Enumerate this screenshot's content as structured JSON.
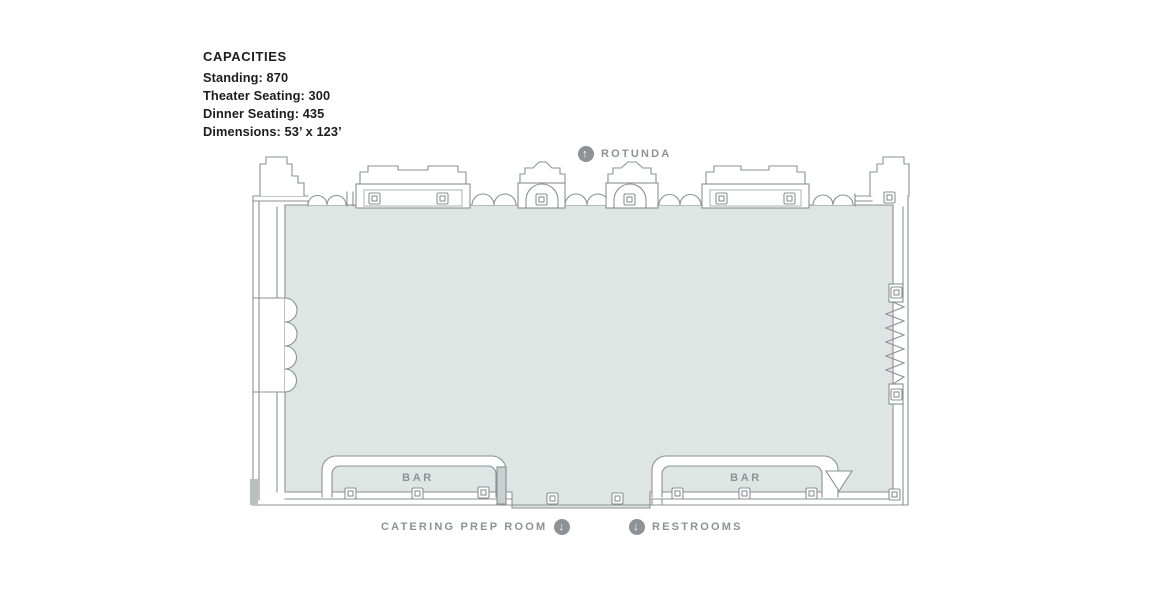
{
  "capacities": {
    "title": "CAPACITIES",
    "lines": [
      "Standing: 870",
      "Theater Seating: 300",
      "Dinner Seating: 435",
      "Dimensions: 53’ x 123’"
    ]
  },
  "labels": {
    "rotunda": "ROTUNDA",
    "bar_left": "BAR",
    "bar_right": "BAR",
    "catering": "CATERING PREP ROOM",
    "restrooms": "RESTROOMS"
  },
  "icons": {
    "rotunda_arrow": "↑",
    "catering_arrow": "↓",
    "restrooms_arrow": "↓"
  },
  "colors": {
    "floor_fill": "#dee6e3",
    "wall_line": "#8b9094",
    "label_text": "#8d9296",
    "icon_bg": "#8d9296",
    "capacities_text": "#1d1d1f"
  }
}
